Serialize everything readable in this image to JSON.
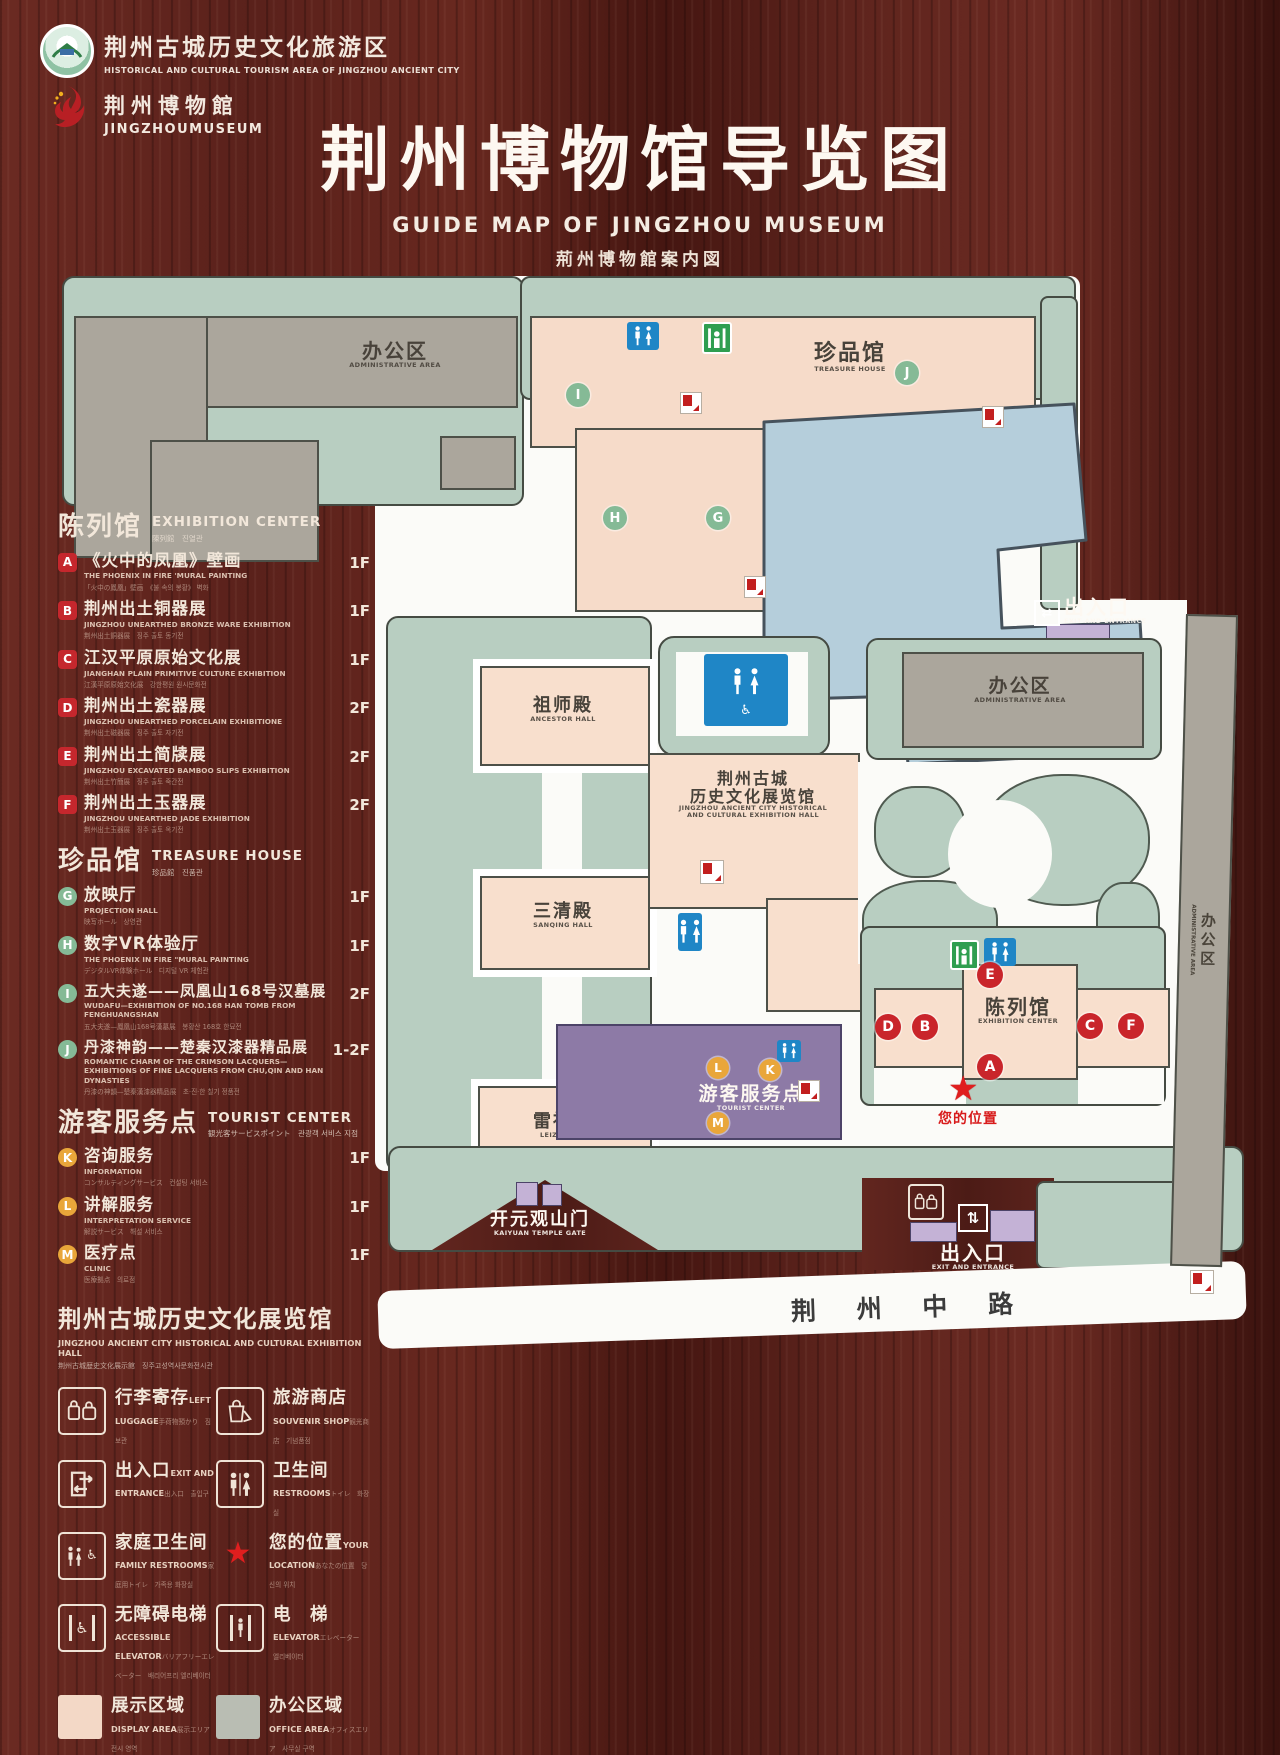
{
  "header": {
    "logo_tourism": {
      "cn": "荆州古城历史文化旅游区",
      "en": "HISTORICAL AND CULTURAL TOURISM AREA OF JINGZHOU ANCIENT CITY"
    },
    "logo_museum": {
      "cn": "荆州博物館",
      "en": "JINGZHOUMUSEUM"
    },
    "title": {
      "cn": "荆州博物馆导览图",
      "en": "GUIDE MAP OF JINGZHOU MUSEUM",
      "jp": "荊州博物館案内図",
      "kr": "징주박물관 안내도"
    }
  },
  "legend": {
    "exhibition": {
      "cn": "陈列馆",
      "en": "EXHIBITION CENTER",
      "sub": "陳列館　진열관",
      "items": [
        {
          "key": "A",
          "cn": "《火中的凤凰》壁画",
          "en": "THE PHOENIX IN FIRE 'MURAL PAINTING",
          "sub": "「火中の鳳凰」壁画　《불 속의 봉황》 벽화",
          "floor": "1F"
        },
        {
          "key": "B",
          "cn": "荆州出土铜器展",
          "en": "JINGZHOU UNEARTHED BRONZE WARE EXHIBITION",
          "sub": "荆州出土銅器展　징주 출토 동기전",
          "floor": "1F"
        },
        {
          "key": "C",
          "cn": "江汉平原原始文化展",
          "en": "JIANGHAN PLAIN PRIMITIVE CULTURE EXHIBITION",
          "sub": "江漢平原原始文化展　강한평원 원시문화전",
          "floor": "1F"
        },
        {
          "key": "D",
          "cn": "荆州出土瓷器展",
          "en": "JINGZHOU UNEARTHED PORCELAIN EXHIBITIONE",
          "sub": "荆州出土磁器展　징주 출토 자기전",
          "floor": "2F"
        },
        {
          "key": "E",
          "cn": "荆州出土简牍展",
          "en": "JINGZHOU EXCAVATED BAMBOO SLIPS EXHIBITION",
          "sub": "荆州出土竹簡展　징주 출토 죽간전",
          "floor": "2F"
        },
        {
          "key": "F",
          "cn": "荆州出土玉器展",
          "en": "JINGZHOU UNEARTHED JADE EXHIBITION",
          "sub": "荆州出土玉器展　징주 출토 옥기전",
          "floor": "2F"
        }
      ]
    },
    "treasure": {
      "cn": "珍品馆",
      "en": "TREASURE HOUSE",
      "sub": "珍品館　진품관",
      "items": [
        {
          "key": "G",
          "cn": "放映厅",
          "en": "PROJECTION HALL",
          "sub": "映写ホール　상영관",
          "floor": "1F"
        },
        {
          "key": "H",
          "cn": "数字VR体验厅",
          "en": "THE PHOENIX IN FIRE \"MURAL PAINTING",
          "sub": "デジタルVR体験ホール　디지털 VR 체험관",
          "floor": "1F"
        },
        {
          "key": "I",
          "cn": "五大夫遂——凤凰山168号汉墓展",
          "en": "WUDAFU—EXHIBITION OF NO.168 HAN TOMB FROM FENGHUANGSHAN",
          "sub": "五大夫遂—鳳凰山168号漢墓展　봉황산 168호 한묘전",
          "floor": "2F"
        },
        {
          "key": "J",
          "cn": "丹漆神韵——楚秦汉漆器精品展",
          "en": "ROMANTIC CHARM OF THE CRIMSON LACQUERS—EXHIBITIONS OF FINE LACQUERS FROM CHU,QIN AND HAN DYNASTIES",
          "sub": "丹漆の神韻—楚秦漢漆器精品展　초·진·한 칠기 정품전",
          "floor": "1-2F"
        }
      ]
    },
    "tourist": {
      "cn": "游客服务点",
      "en": "TOURIST CENTER",
      "sub": "観光客サービスポイント　관광객 서비스 지점",
      "items": [
        {
          "key": "K",
          "cn": "咨询服务",
          "en": "INFORMATION",
          "sub": "コンサルティングサービス　컨설팅 서비스",
          "floor": "1F"
        },
        {
          "key": "L",
          "cn": "讲解服务",
          "en": "INTERPRETATION SERVICE",
          "sub": "解説サービス　해설 서비스",
          "floor": "1F"
        },
        {
          "key": "M",
          "cn": "医疗点",
          "en": "CLINIC",
          "sub": "医療拠点　의료점",
          "floor": "1F"
        }
      ]
    },
    "hall_note": {
      "cn": "荆州古城历史文化展览馆",
      "en": "JINGZHOU ANCIENT CITY HISTORICAL AND CULTURAL EXHIBITION HALL",
      "sub": "荆州古城歴史文化展示館　징주고성역사문화전시관"
    },
    "facilities": [
      {
        "cn": "行李寄存",
        "en": "LEFT LUGGAGE",
        "sub": "手荷物預かり　짐 보관"
      },
      {
        "cn": "旅游商店",
        "en": "SOUVENIR SHOP",
        "sub": "観光商店　기념품점"
      },
      {
        "cn": "出入口",
        "en": "EXIT AND ENTRANCE",
        "sub": "出入口　출입구"
      },
      {
        "cn": "卫生间",
        "en": "RESTROOMS",
        "sub": "トイレ　화장실"
      },
      {
        "cn": "家庭卫生间",
        "en": "FAMILY RESTROOMS",
        "sub": "家庭用トイレ　가족용 화장실"
      },
      {
        "cn": "您的位置",
        "en": "YOUR LOCATION",
        "sub": "あなたの位置　당신의 위치"
      },
      {
        "cn": "无障碍电梯",
        "en": "ACCESSIBLE ELEVATOR",
        "sub": "バリアフリーエレベーター　배리어프리 엘리베이터"
      },
      {
        "cn": "电　梯",
        "en": "ELEVATOR",
        "sub": "エレベーター　엘리베이터"
      }
    ],
    "areas": [
      {
        "cn": "展示区域",
        "en": "DISPLAY AREA",
        "sub": "展示エリア　전시 영역",
        "style": "background:#f3d8c6"
      },
      {
        "cn": "办公区域",
        "en": "OFFICE AREA",
        "sub": "オフィスエリア　사무실 구역",
        "style": "background:#b9bdb3"
      }
    ]
  },
  "map": {
    "labels": {
      "admin_top": {
        "cn": "办公区",
        "en": "ADMINISTRATIVE AREA"
      },
      "treasure": {
        "cn": "珍品馆",
        "en": "TREASURE HOUSE"
      },
      "exit_top": {
        "cn": "出入口",
        "en": "EXIT AND ENTRANCE"
      },
      "admin_right": {
        "cn": "办公区",
        "en": "ADMINISTRATIVE AREA"
      },
      "admin_strip": {
        "cn": "办公区",
        "en": "ADMINISTRATIVE AREA"
      },
      "ancestor": {
        "cn": "祖师殿",
        "en": "ANCESTOR HALL"
      },
      "sanqing": {
        "cn": "三清殿",
        "en": "SANQING HALL"
      },
      "leizu": {
        "cn": "雷祖殿",
        "en": "LEIZU HALL"
      },
      "exhibition_hall": {
        "cn1": "荆州古城",
        "cn2": "历史文化展览馆",
        "en1": "JINGZHOU ANCIENT CITY HISTORICAL",
        "en2": "AND CULTURAL EXHIBITION HALL"
      },
      "exhibition_center": {
        "cn": "陈列馆",
        "en": "EXHIBITION CENTER"
      },
      "tourist_center": {
        "cn": "游客服务点",
        "en": "TOURIST CENTER"
      },
      "your_location": {
        "cn": "您的位置"
      },
      "gate": {
        "cn": "开元观山门",
        "en": "KAIYUAN TEMPLE GATE"
      },
      "exit_bottom": {
        "cn": "出入口",
        "en": "EXIT AND ENTRANCE"
      },
      "road": {
        "cn": "荆 州 中 路"
      }
    },
    "markers": {
      "A": "A",
      "B": "B",
      "C": "C",
      "D": "D",
      "E": "E",
      "F": "F",
      "G": "G",
      "H": "H",
      "I": "I",
      "J": "J",
      "K": "K",
      "L": "L",
      "M": "M"
    }
  },
  "palette": {
    "lawn": "#b8cec1",
    "building_pink": "#f6dbc9",
    "building_gray": "#aba69c",
    "pond": "#b5cedb",
    "tourist_purple": "#8d7aa6",
    "gate_lavender": "#c4b2d6",
    "marker_red": "#c9252b",
    "marker_green": "#85ba96",
    "marker_orange": "#e9a63a",
    "wc_blue": "#1f86c6",
    "elevator_green": "#2f9e50",
    "star_red": "#e01e1e"
  }
}
